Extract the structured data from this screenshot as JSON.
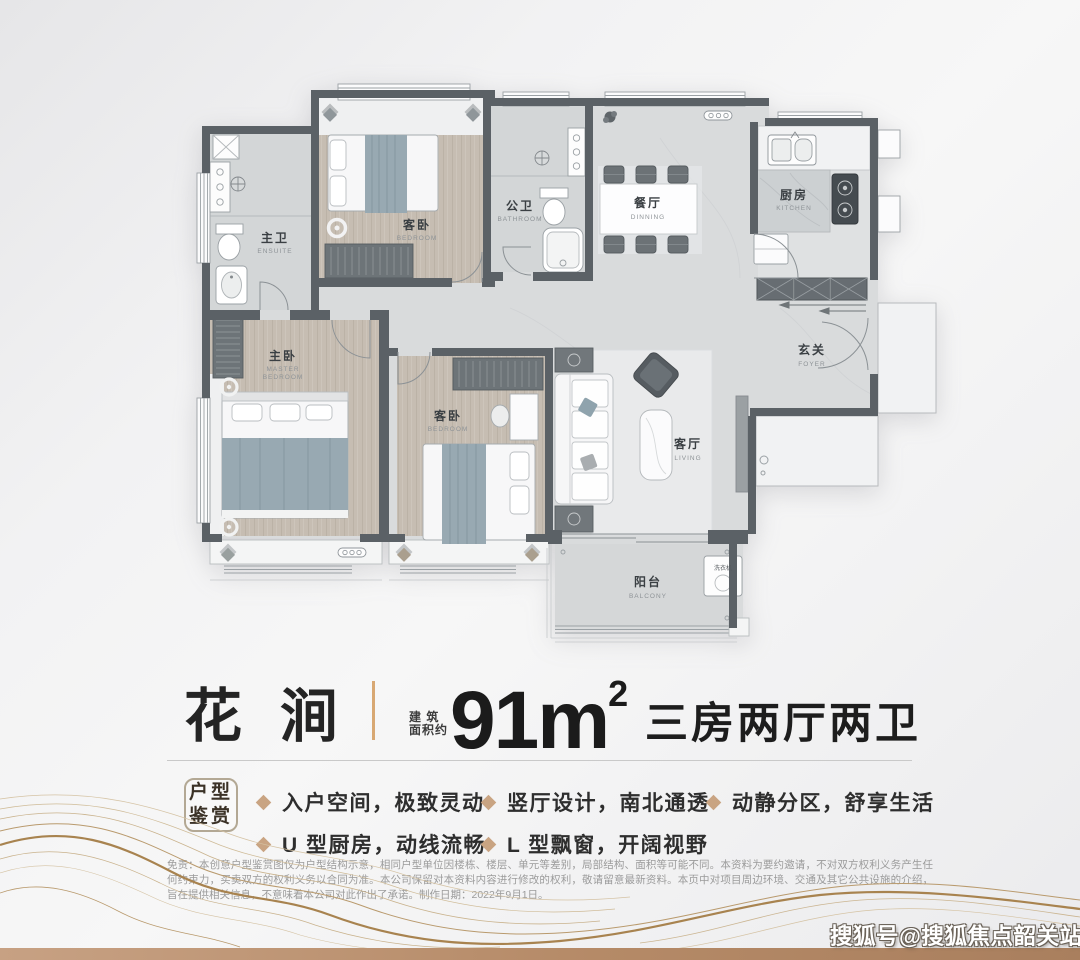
{
  "title": {
    "name": "花涧",
    "area_caption_line1": "建 筑",
    "area_caption_line2": "面积约",
    "area_value": "91m",
    "area_exponent": "2",
    "layout_text": "三房两厅两卫"
  },
  "features": {
    "badge_line1": "户型",
    "badge_line2": "鉴赏",
    "items": [
      "入户空间，极致灵动",
      "U 型厨房，动线流畅",
      "竖厅设计，南北通透",
      "L 型飘窗，开阔视野",
      "动静分区，舒享生活"
    ]
  },
  "floor_plan": {
    "rooms": [
      {
        "id": "ensuite",
        "zh": "主卫",
        "en": "ENSUITE"
      },
      {
        "id": "bedroom-top",
        "zh": "客卧",
        "en": "BEDROOM"
      },
      {
        "id": "bathroom",
        "zh": "公卫",
        "en": "BATHROOM"
      },
      {
        "id": "dining",
        "zh": "餐厅",
        "en": "DINNING"
      },
      {
        "id": "kitchen",
        "zh": "厨房",
        "en": "KITCHEN"
      },
      {
        "id": "foyer",
        "zh": "玄关",
        "en": "FOYER"
      },
      {
        "id": "master-bedroom",
        "zh": "主卧",
        "en1": "MASTER",
        "en2": "BEDROOM"
      },
      {
        "id": "bedroom-mid",
        "zh": "客卧",
        "en": "BEDROOM"
      },
      {
        "id": "living",
        "zh": "客厅",
        "en": "LIVING"
      },
      {
        "id": "balcony",
        "zh": "阳台",
        "en": "BALCONY"
      }
    ],
    "washer_label": "洗衣机"
  },
  "disclaimer": "免责：本创意户型鉴赏图仅为户型结构示意，相同户型单位因楼栋、楼层、单元等差别，局部结构、面积等可能不同。本资料为要约邀请，不对双方权利义务产生任何约束力，买卖双方的权利义务以合同为准。本公司保留对本资料内容进行修改的权利，敬请留意最新资料。本页中对项目周边环境、交通及其它公共设施的介绍，旨在提供相关信息，不意味着本公司对此作出了承诺。制作日期：2022年9月1日。",
  "watermark": "搜狐号@搜狐焦点韶关站",
  "colors": {
    "accent_gold": "#d8a873",
    "bullet_diamond": "#c9a482",
    "wall": "#5b6166",
    "wood_floor": "#c6bdb2",
    "marble_floor": "#d9dbdc",
    "blanket_teal": "#98a9b2",
    "bottom_bar_left": "#c7a183",
    "bottom_bar_right": "#a97f5e"
  }
}
